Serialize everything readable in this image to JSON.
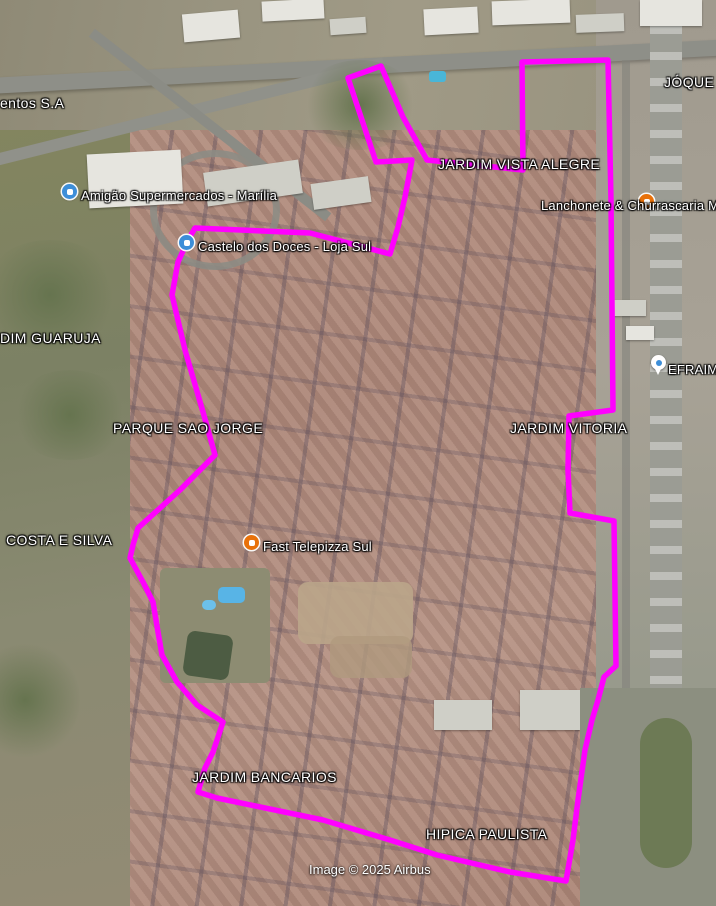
{
  "map": {
    "attribution": "Image © 2025 Airbus",
    "area_labels": [
      {
        "text": "entos S.A"
      },
      {
        "text": "JÓQUE"
      },
      {
        "text": "JARDIM VISTA ALEGRE"
      },
      {
        "text": "DIM GUARUJA"
      },
      {
        "text": "PARQUE SAO JORGE"
      },
      {
        "text": "JARDIM VITORIA"
      },
      {
        "text": "COSTA E SILVA"
      },
      {
        "text": "Fast Telepizza Sul"
      },
      {
        "text": "JARDIM BANCARIOS"
      },
      {
        "text": "HIPICA PAULISTA"
      }
    ],
    "poi_labels": [
      {
        "text": "Amigão Supermercados - Marília",
        "marker": "blue-shopping"
      },
      {
        "text": "Castelo dos Doces - Loja Sul",
        "marker": "blue-shopping"
      },
      {
        "text": "Lanchonete & Churrascaria Me",
        "marker": "orange-restaurant"
      },
      {
        "text": "Fast Telepizza Sul",
        "marker": "orange-restaurant"
      },
      {
        "text": "EFRAIM",
        "marker": "white-pin"
      }
    ],
    "marker_colors": {
      "blue": "#3d8ed8",
      "orange": "#e8710a"
    }
  },
  "overlay": {
    "polygon_color": "#ff00ff",
    "polygon_points": "195,228 310,233 390,254 398,227 405,197 412,160 376,162 348,78 381,66 403,117 427,160 523,170 522,62 608,60 611,200 613,410 569,416 568,470 570,513 614,521 616,666 604,677 598,700 592,720 585,750 578,800 573,840 566,881 510,872 437,855 390,840 323,820 217,798 198,792 205,768 213,752 223,722 197,705 177,682 162,655 158,632 153,602 143,582 130,558 133,545 138,528 180,490 215,455 203,412 185,350 172,295 178,262 188,240"
  }
}
